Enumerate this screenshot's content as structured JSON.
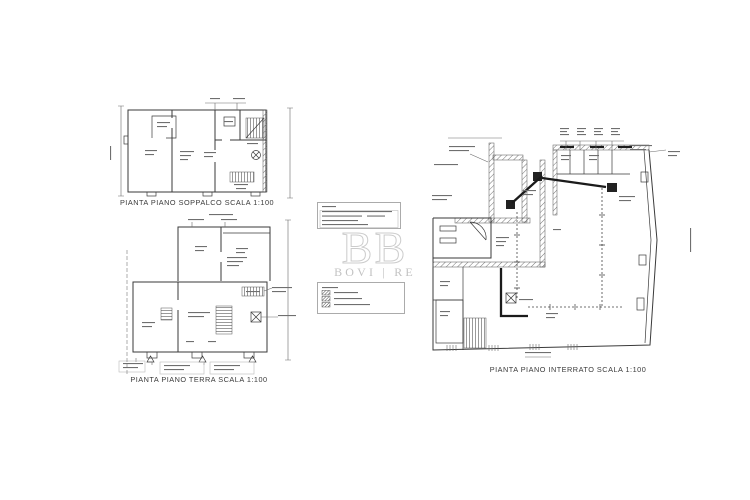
{
  "document": {
    "kind": "architectural-floor-plan-sheet"
  },
  "plans": {
    "soppalco": {
      "title": "PIANTA PIANO SOPPALCO SCALA 1:100"
    },
    "terra": {
      "title": "PIANTA PIANO TERRA SCALA 1:100"
    },
    "interrato": {
      "title": "PIANTA PIANO INTERRATO SCALA 1:100"
    }
  },
  "watermark": {
    "wordmark": "BOVI | RE",
    "monogram": "B"
  },
  "colors": {
    "background": "#ffffff",
    "line": "#3a3a3a",
    "wall_dark": "#1b1b1b",
    "watermark": "#c6c6c6"
  }
}
